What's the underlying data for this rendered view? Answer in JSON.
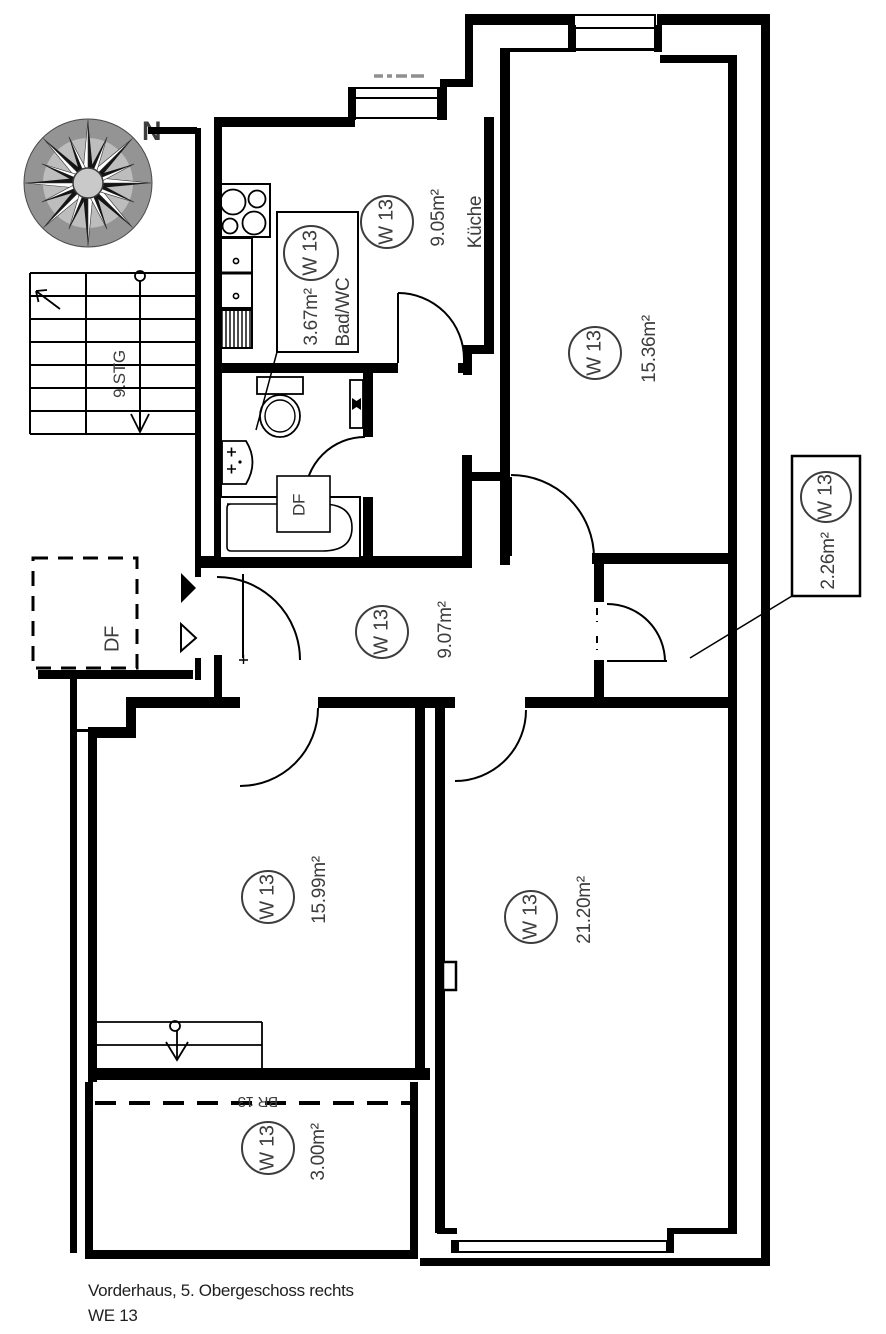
{
  "title": {
    "line1": "Vorderhaus, 5. Obergeschoss rechts",
    "line2": "WE 13"
  },
  "compass": {
    "north": "N"
  },
  "staircase": {
    "label": "9.STG"
  },
  "skylights": {
    "df_plan": "DF",
    "df_bath": "DF"
  },
  "balcony_code": "BR 13",
  "rooms": {
    "kueche": {
      "unit": "W 13",
      "area": "9.05m²",
      "name": "Küche"
    },
    "bad": {
      "unit": "W 13",
      "area": "3.67m²",
      "name": "Bad/WC"
    },
    "zimmer1": {
      "unit": "W 13",
      "area": "15.36m²"
    },
    "flur": {
      "unit": "W 13",
      "area": "9.07m²"
    },
    "kammer": {
      "unit": "W 13",
      "area": "2.26m²"
    },
    "zimmer2": {
      "unit": "W 13",
      "area": "15.99m²"
    },
    "zimmer3": {
      "unit": "W 13",
      "area": "21.20m²"
    },
    "balkon": {
      "unit": "W 13",
      "area": "3.00m²"
    }
  },
  "colors": {
    "wall": "#000000",
    "label_text": "#3d3d3d",
    "compass_dark": "#949494",
    "compass_light": "#bdbdbd"
  }
}
